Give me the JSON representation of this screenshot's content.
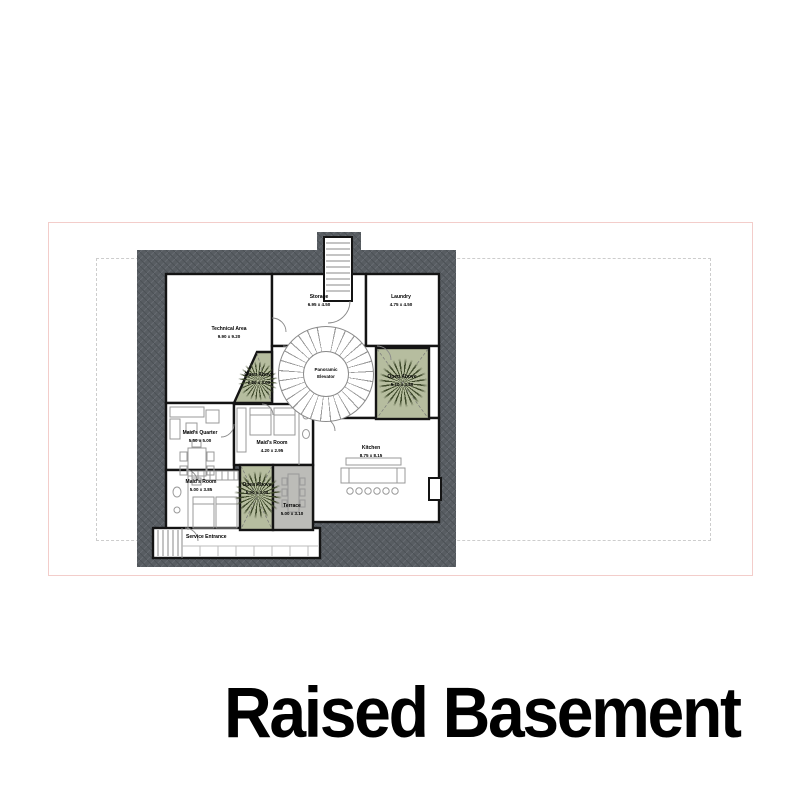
{
  "title": "Raised Basement",
  "rooms": {
    "technical": {
      "name": "Technical Area",
      "dims": "9.90 x 9.20"
    },
    "storage": {
      "name": "Storage",
      "dims": "6.95 x 4.50"
    },
    "laundry": {
      "name": "Laundry",
      "dims": "4.75 x 4.50"
    },
    "maids_quarter": {
      "name": "Maid's Quarter",
      "dims": "5.50 x 5.00"
    },
    "maids_room_mid": {
      "name": "Maid's Room",
      "dims": "4.20 x 2.95"
    },
    "maids_room_low": {
      "name": "Maid's Room",
      "dims": "5.00 x 3.85"
    },
    "kitchen": {
      "name": "Kitchen",
      "dims": "8.75 x 8.15"
    },
    "terrace": {
      "name": "Terrace",
      "dims": "5.00 x 3.10"
    },
    "service_entrance": {
      "name": "Service Entrance"
    },
    "elevator": {
      "line1": "Panoramic",
      "line2": "Elevator"
    },
    "shaft_left": {
      "name": "Open Above",
      "dims": "2.60 x 3.00"
    },
    "shaft_right": {
      "name": "Open Above",
      "dims": "5.10 x 3.80"
    },
    "shaft_bottom": {
      "name": "Open Above",
      "dims": "5.00 x 3.00"
    }
  },
  "colors": {
    "building_fill": "#585d62",
    "wall": "#141414",
    "plant_area": "#b6bd9f",
    "terrace_floor": "#bcbcb8",
    "sheet_border": "#f3cdca",
    "boundary_dash": "#cdcdcd"
  }
}
